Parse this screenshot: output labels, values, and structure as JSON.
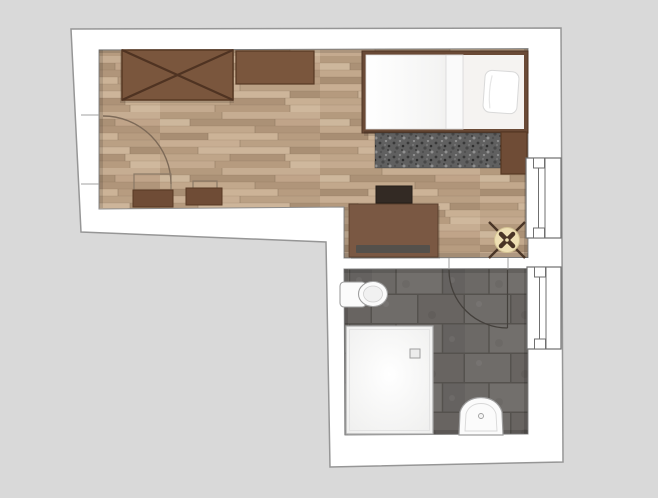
{
  "canvas": {
    "width": 658,
    "height": 498,
    "background": "#d9d9d9"
  },
  "plan": {
    "title": "Studio apartment floor plan with bathroom",
    "rooms": [
      {
        "id": "main-room",
        "name": "living-sleeping-room",
        "floor_material": "wood-parquet"
      },
      {
        "id": "bathroom",
        "name": "bathroom",
        "floor_material": "dark-gray-tile"
      }
    ],
    "furniture": [
      {
        "room": "main-room",
        "name": "wardrobe-with-cross"
      },
      {
        "room": "main-room",
        "name": "sideboard"
      },
      {
        "room": "main-room",
        "name": "single-bed"
      },
      {
        "room": "main-room",
        "name": "pillow"
      },
      {
        "room": "main-room",
        "name": "duvet"
      },
      {
        "room": "main-room",
        "name": "shaggy-rug"
      },
      {
        "room": "main-room",
        "name": "nightstand"
      },
      {
        "room": "main-room",
        "name": "console-table-large"
      },
      {
        "room": "main-room",
        "name": "console-table-small"
      },
      {
        "room": "main-room",
        "name": "bench-left"
      },
      {
        "room": "main-room",
        "name": "bench-right"
      },
      {
        "room": "main-room",
        "name": "desk"
      },
      {
        "room": "main-room",
        "name": "desk-chair"
      },
      {
        "room": "main-room",
        "name": "round-stool"
      },
      {
        "room": "bathroom",
        "name": "toilet"
      },
      {
        "room": "bathroom",
        "name": "shower-tray"
      },
      {
        "room": "bathroom",
        "name": "washbasin"
      }
    ],
    "openings": [
      {
        "name": "entry-door",
        "type": "door",
        "wall": "left"
      },
      {
        "name": "bathroom-door",
        "type": "door",
        "wall": "between-main-room-and-bathroom"
      },
      {
        "name": "window-main",
        "type": "window",
        "wall": "right"
      },
      {
        "name": "window-bathroom",
        "type": "window",
        "wall": "right"
      }
    ]
  },
  "colors": {
    "background": "#d9d9d9",
    "wall": "#ffffff",
    "outline": "#969696",
    "floor_edge": "#8c8c8c",
    "furniture_brown": "#7a563d",
    "furniture_brown_dark": "#573823",
    "wardrobe_cross": "#4f3322",
    "bed_frame": "#6a4a36",
    "bed_frame_dark": "#4f3525",
    "sheet": "#f5f3f1",
    "bedding": "#fafafa",
    "rug": "#606060",
    "nightstand": "#6f4c36",
    "desk": "#7a5843",
    "desk_drawer": "#54504b",
    "chair": "#332a24",
    "stool_seat": "#eedfb3",
    "stool_rim": "#d3c293",
    "stool_legs": "#4a3526",
    "fixture": "#fbfbfb",
    "fixture_stroke": "#9e9e9e",
    "window_stroke": "#6f6f6f",
    "arc_wood": "#7d6a58",
    "arc_dark": "#44403c",
    "console_outline": "#8a7966",
    "jamb": "#a0a0a0",
    "shadow": "rgba(0,0,0,0.12)"
  }
}
